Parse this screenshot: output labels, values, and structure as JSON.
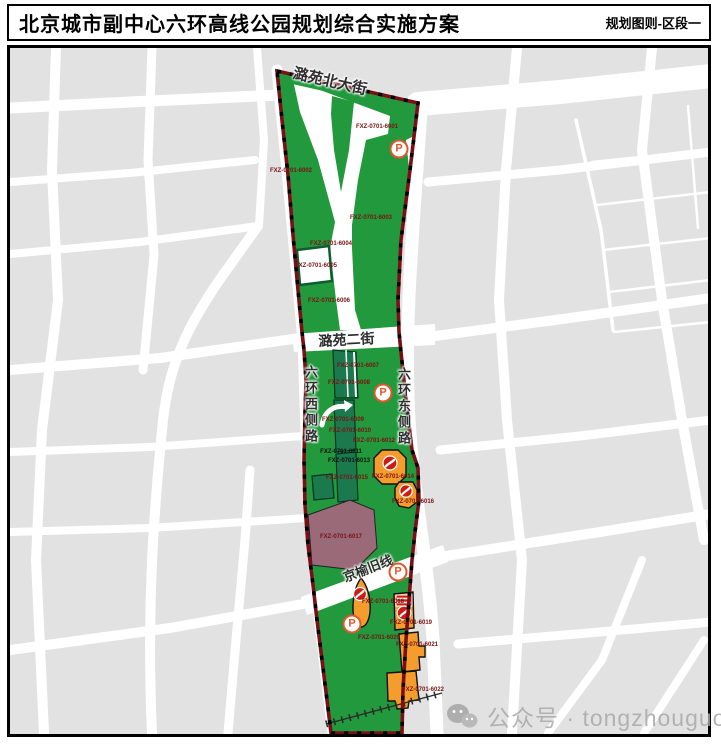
{
  "header": {
    "title": "北京城市副中心六环高线公园规划综合实施方案",
    "section_label": "规划图则-区段一"
  },
  "map": {
    "street_names": {
      "luyuan_north_ave": "潞苑北大街",
      "luyuan_2nd_st": "潞苑二街",
      "jingyu_old_line": "京榆旧线",
      "sixth_ring_west_side": "六环西侧路",
      "sixth_ring_east_side": "六环东侧路"
    },
    "parking_label": "P",
    "parcel_labels": [
      "FXZ-0701-6001",
      "FXZ-0701-6002",
      "FXZ-0701-6003",
      "FXZ-0701-6004",
      "FXZ-0701-6005",
      "FXZ-0701-6006",
      "FXZ-0701-6007",
      "FXZ-0701-6008",
      "FXZ-0701-6009",
      "FXZ-0701-6010",
      "FXZ-0701-6011",
      "FXZ-0701-6012",
      "FXZ-0701-6013",
      "FXZ-0701-6014",
      "FXZ-0701-6015",
      "FXZ-0701-6016",
      "FXZ-0701-6017",
      "FXZ-0701-6018",
      "FXZ-0701-6019",
      "FXZ-0701-6020",
      "FXZ-0701-6021",
      "FXZ-0701-6022"
    ],
    "legend_colors": {
      "park_green": "#22993c",
      "subparcel_dark_green": "#1a7a4e",
      "boundary_dark_red": "#7a1016",
      "facility_orange": "#f59d2c",
      "culture_purple": "#9a6a78",
      "icon_red": "#cf1b15",
      "parking_orange": "#e2572a",
      "city_block_gray": "#e2e2e2"
    }
  },
  "watermark": {
    "text": "公众号 · tongzhouguo"
  }
}
